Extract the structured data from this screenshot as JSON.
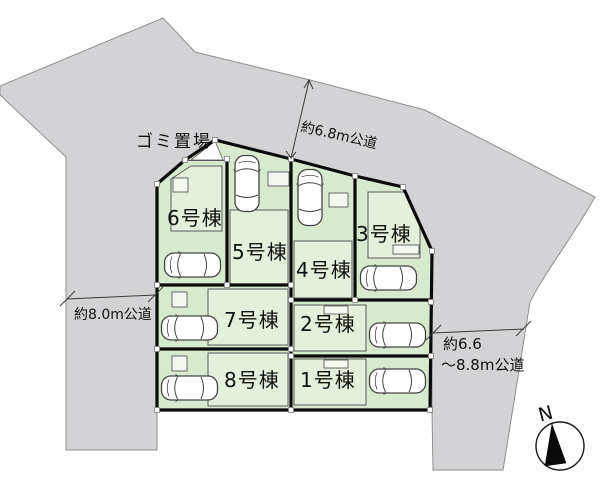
{
  "plan": {
    "units": [
      {
        "id": 1,
        "label": "1号棟"
      },
      {
        "id": 2,
        "label": "2号棟"
      },
      {
        "id": 3,
        "label": "3号棟"
      },
      {
        "id": 4,
        "label": "4号棟"
      },
      {
        "id": 5,
        "label": "5号棟"
      },
      {
        "id": 6,
        "label": "6号棟"
      },
      {
        "id": 7,
        "label": "7号棟"
      },
      {
        "id": 8,
        "label": "8号棟"
      }
    ],
    "garbage_label": "ゴミ置場",
    "roads": {
      "top": "約6.8m公道",
      "left": "約8.0m公道",
      "right_line1": "約6.6",
      "right_line2": "～8.8m公道"
    },
    "compass": {
      "label": "N"
    },
    "colors": {
      "road_gray": "#d3d3d5",
      "parcel_green": "#d8eace",
      "building_green": "#e4f0da",
      "boundary_black": "#0a0a0a"
    }
  }
}
